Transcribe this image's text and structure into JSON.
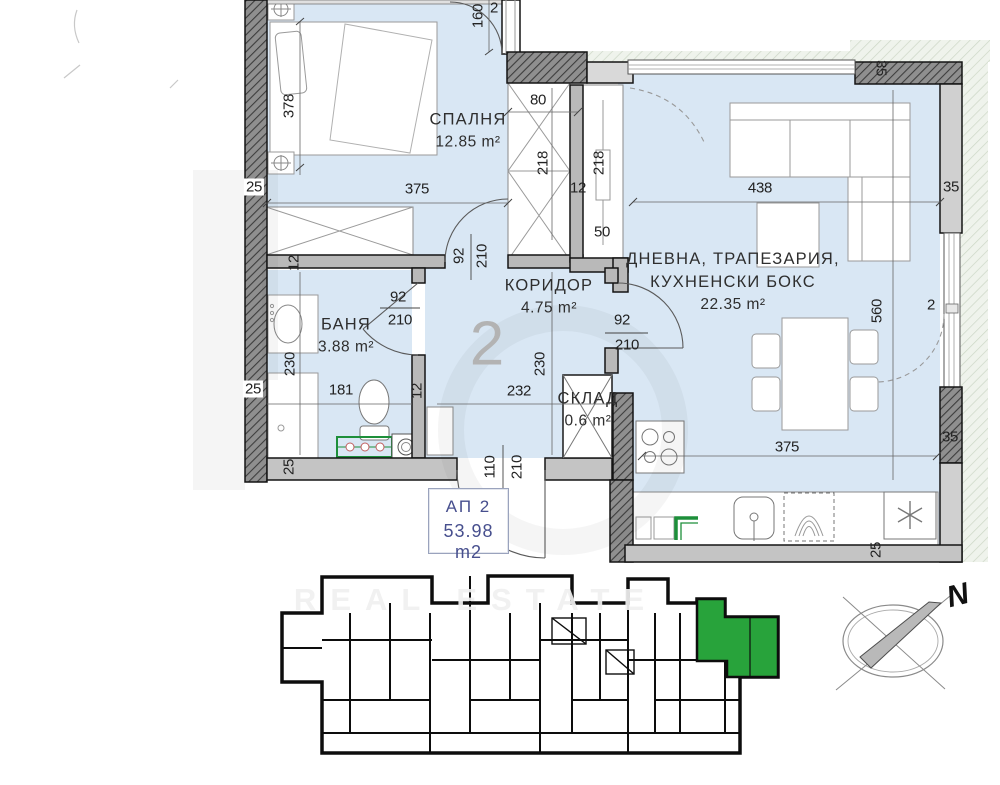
{
  "plan": {
    "unit_big_number": "2",
    "badge": {
      "title": "АП 2",
      "area": "53.98 m2"
    },
    "compass": {
      "north_label": "N"
    },
    "watermark": {
      "text": "REAL ESTATE"
    },
    "rooms": [
      {
        "id": "bedroom",
        "x": 468,
        "y": 131,
        "lines": [
          "СПАЛНЯ",
          "12.85 m²"
        ]
      },
      {
        "id": "bathroom",
        "x": 346,
        "y": 336,
        "lines": [
          "БАНЯ",
          "3.88 m²"
        ]
      },
      {
        "id": "corridor",
        "x": 549,
        "y": 297,
        "lines": [
          "КОРИДОР",
          "4.75 m²"
        ]
      },
      {
        "id": "living",
        "x": 733,
        "y": 282,
        "lines": [
          "ДНЕВНА, ТРАПЕЗАРИЯ,",
          "КУХНЕНСКИ БОКС",
          "22.35 m²"
        ]
      },
      {
        "id": "storage",
        "x": 588,
        "y": 410,
        "lines": [
          "СКЛАД",
          "0.6 m²"
        ]
      }
    ],
    "dimensions": [
      {
        "t": "25",
        "x": 254,
        "y": 187,
        "r": 0,
        "bg": true
      },
      {
        "t": "378",
        "x": 289,
        "y": 106,
        "r": -90
      },
      {
        "t": "2",
        "x": 494,
        "y": 8,
        "r": 0
      },
      {
        "t": "160",
        "x": 478,
        "y": 16,
        "r": -90
      },
      {
        "t": "375",
        "x": 417,
        "y": 189,
        "r": 0
      },
      {
        "t": "80",
        "x": 538,
        "y": 100,
        "r": 0
      },
      {
        "t": "218",
        "x": 543,
        "y": 163,
        "r": -90
      },
      {
        "t": "12",
        "x": 578,
        "y": 188,
        "r": 0
      },
      {
        "t": "218",
        "x": 599,
        "y": 163,
        "r": -90
      },
      {
        "t": "50",
        "x": 602,
        "y": 232,
        "r": 0
      },
      {
        "t": "92",
        "x": 459,
        "y": 256,
        "r": -90
      },
      {
        "t": "210",
        "x": 482,
        "y": 256,
        "r": -90
      },
      {
        "t": "12",
        "x": 294,
        "y": 263,
        "r": -90
      },
      {
        "t": "25",
        "x": 253,
        "y": 389,
        "r": 0,
        "bg": true
      },
      {
        "t": "92",
        "x": 398,
        "y": 297,
        "r": 0
      },
      {
        "t": "210",
        "x": 400,
        "y": 320,
        "r": 0
      },
      {
        "t": "230",
        "x": 290,
        "y": 364,
        "r": -90
      },
      {
        "t": "181",
        "x": 341,
        "y": 390,
        "r": 0
      },
      {
        "t": "230",
        "x": 540,
        "y": 364,
        "r": -90
      },
      {
        "t": "232",
        "x": 519,
        "y": 391,
        "r": 0
      },
      {
        "t": "12",
        "x": 417,
        "y": 391,
        "r": -90
      },
      {
        "t": "92",
        "x": 622,
        "y": 320,
        "r": 0
      },
      {
        "t": "210",
        "x": 627,
        "y": 345,
        "r": 0
      },
      {
        "t": "110",
        "x": 490,
        "y": 467,
        "r": -90
      },
      {
        "t": "210",
        "x": 517,
        "y": 467,
        "r": -90
      },
      {
        "t": "25",
        "x": 289,
        "y": 467,
        "r": -90
      },
      {
        "t": "438",
        "x": 760,
        "y": 188,
        "r": 0
      },
      {
        "t": "35",
        "x": 881,
        "y": 68,
        "r": 90
      },
      {
        "t": "35",
        "x": 951,
        "y": 187,
        "r": 0
      },
      {
        "t": "560",
        "x": 877,
        "y": 311,
        "r": -90
      },
      {
        "t": "2",
        "x": 931,
        "y": 305,
        "r": 0
      },
      {
        "t": "375",
        "x": 787,
        "y": 447,
        "r": 0
      },
      {
        "t": "35",
        "x": 950,
        "y": 437,
        "r": 0
      },
      {
        "t": "25",
        "x": 876,
        "y": 550,
        "r": -90
      }
    ]
  }
}
